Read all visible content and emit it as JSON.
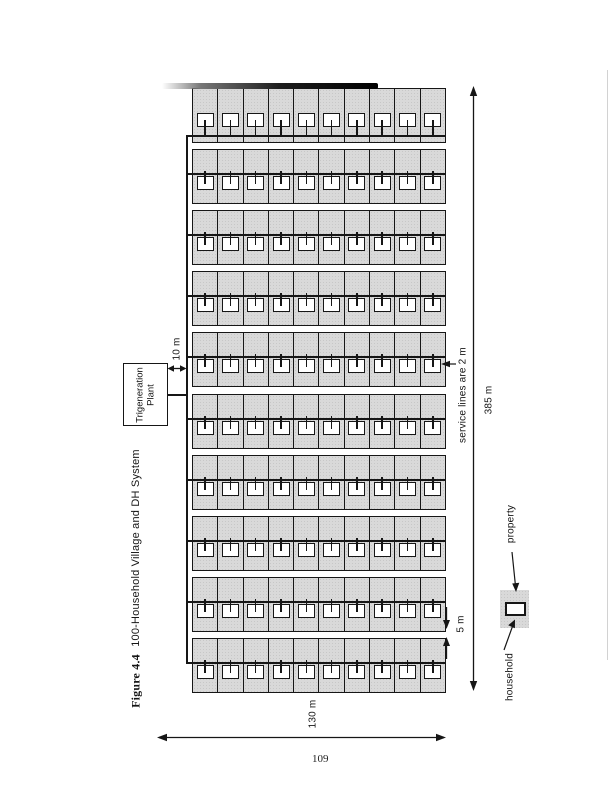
{
  "page": {
    "number": "109",
    "background": "#ffffff"
  },
  "caption": {
    "figure_label": "Figure 4.4",
    "figure_title": "100-Household Village and DH System"
  },
  "plant": {
    "label_line1": "Trigeneration",
    "label_line2": "Plant"
  },
  "dimensions": {
    "plant_to_grid": "10 m",
    "grid_height": "385 m",
    "street_gap": "5 m",
    "grid_width": "130 m",
    "service_note": "service lines are 2 m"
  },
  "legend": {
    "household_label": "household",
    "property_label": "property"
  },
  "grid": {
    "rows": 10,
    "cols": 10,
    "total_households": 100
  },
  "colors": {
    "plot_fill": "#d9d9d9",
    "line": "#161616",
    "house_fill": "#ffffff"
  }
}
